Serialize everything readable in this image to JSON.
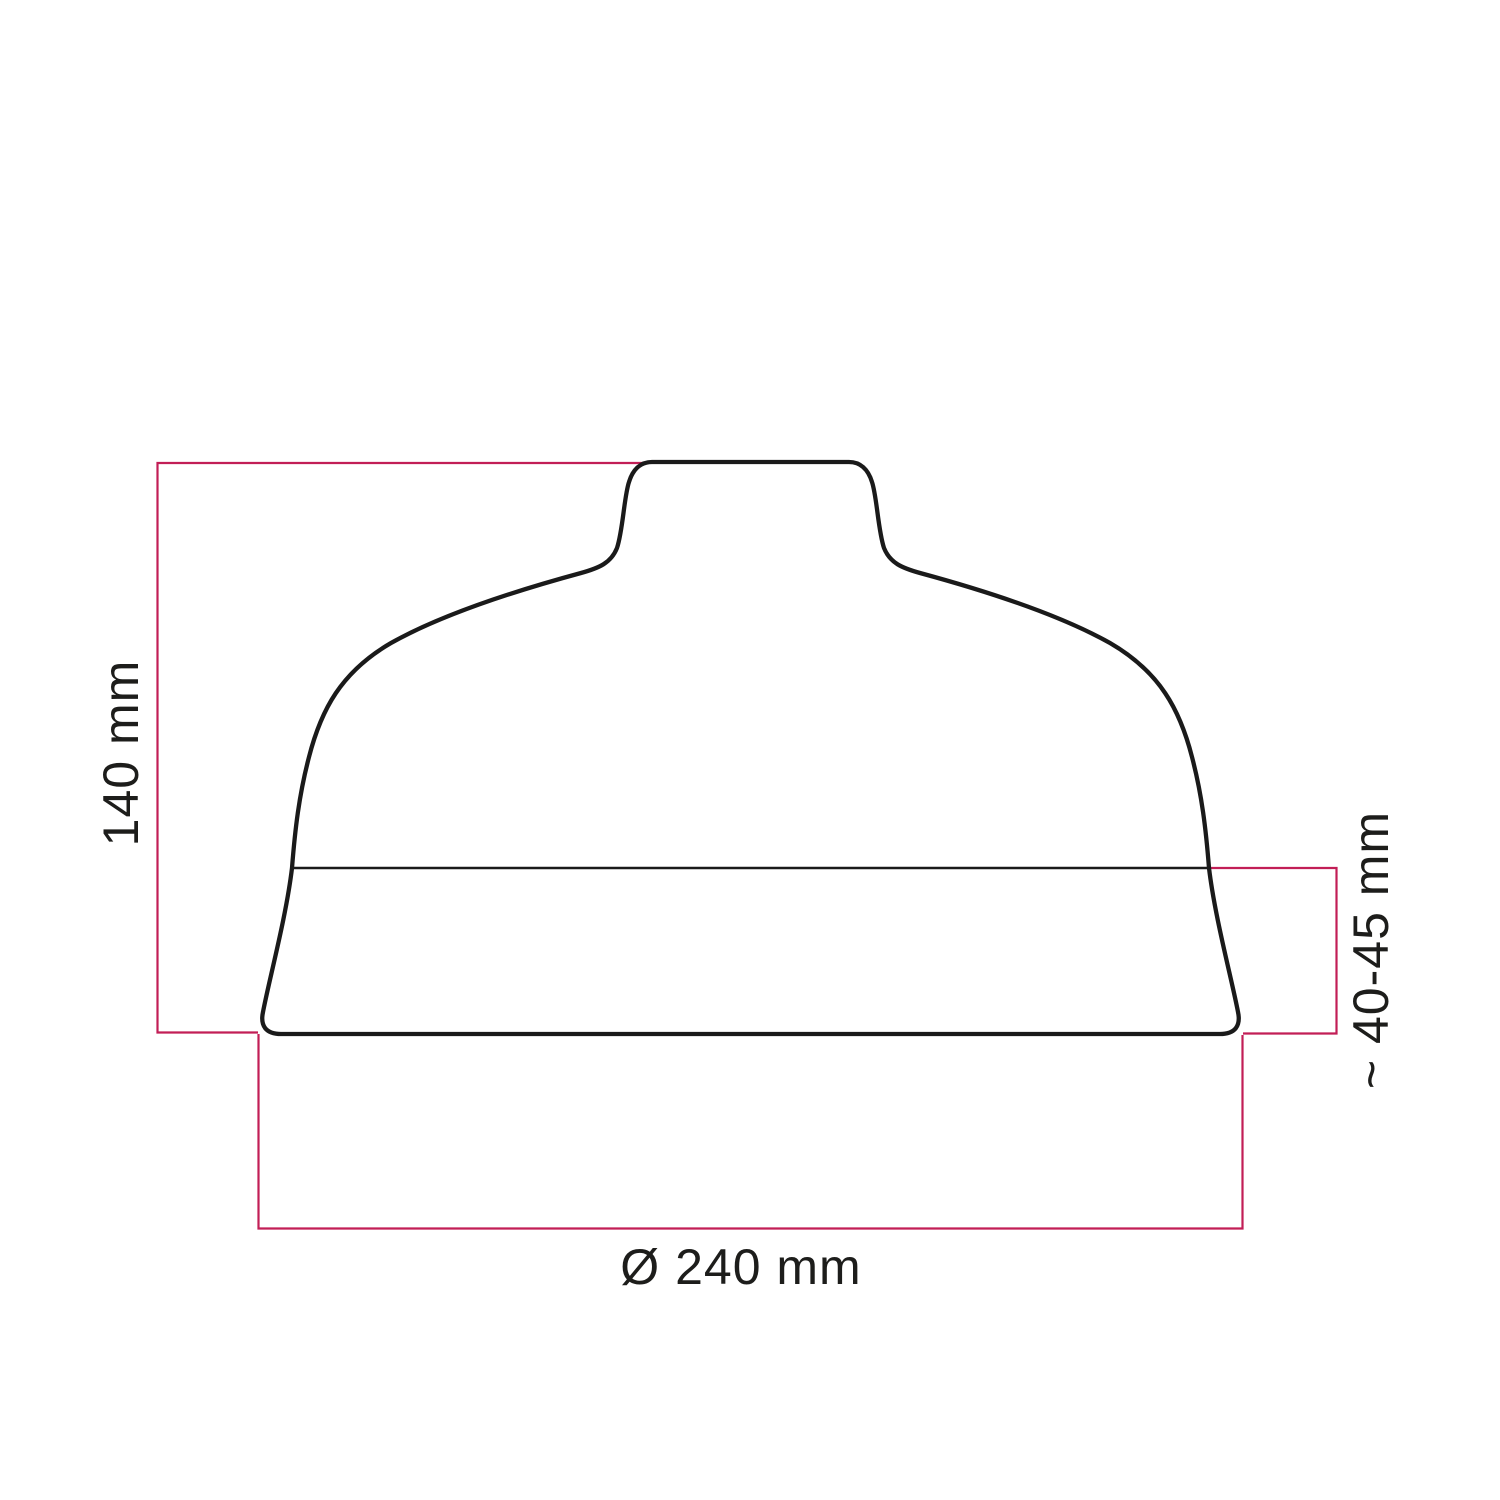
{
  "diagram": {
    "kind": "technical-dimension-drawing",
    "subject": "lampshade-profile-silhouette",
    "labels": {
      "height": "140 mm",
      "band_height": "~ 40-45 mm",
      "diameter": "Ø 240 mm"
    },
    "colors": {
      "dimension_line": "#C21E56",
      "outline": "#1A1A1A",
      "text": "#1D1D1B",
      "background": "#FFFFFF"
    }
  }
}
